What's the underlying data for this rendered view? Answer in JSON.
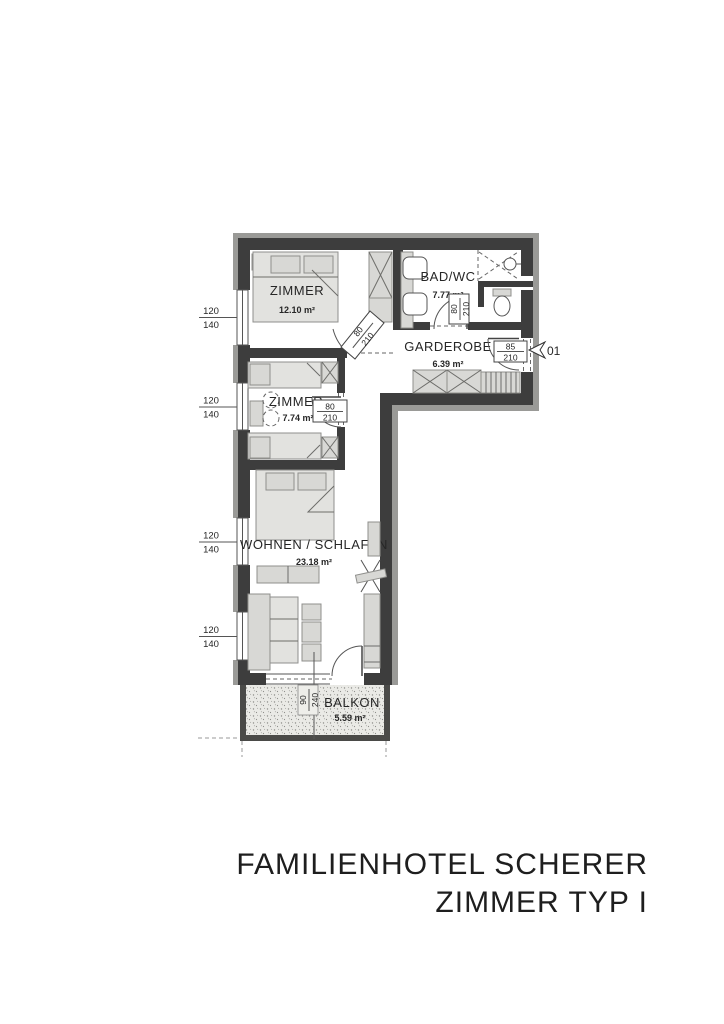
{
  "document": {
    "type": "architectural floor plan"
  },
  "title": {
    "line1": "FAMILIENHOTEL SCHERER",
    "line2": "ZIMMER TYP I"
  },
  "rooms": {
    "zimmer1": {
      "name": "ZIMMER",
      "area": "12.10 m²"
    },
    "badwc": {
      "name": "BAD/WC",
      "area": "7.77 m²"
    },
    "garderobe": {
      "name": "GARDEROBE",
      "area": "6.39 m²"
    },
    "zimmer2": {
      "name": "ZIMMER",
      "area": "7.74 m²"
    },
    "wohnen": {
      "name": "WOHNEN / SCHLAFEN",
      "area": "23.18 m²"
    },
    "balkon": {
      "name": "BALKON",
      "area": "5.59 m²"
    }
  },
  "doors": {
    "entrance": {
      "width": "85",
      "height": "210"
    },
    "badwc": {
      "width": "80",
      "height": "210"
    },
    "zimmer1": {
      "width": "80",
      "height": "210"
    },
    "zimmer2": {
      "width": "80",
      "height": "210"
    },
    "balcony": {
      "width": "90",
      "height": "240"
    }
  },
  "windows": {
    "width": "120",
    "height": "140"
  },
  "entrance_marker": "01",
  "colors": {
    "wall": "#3d3d3d",
    "wall_outer_band": "#9a9a97",
    "furniture": "#d8d8d5",
    "balcony_fill": "#eaeae6",
    "text": "#1f1f1f"
  }
}
